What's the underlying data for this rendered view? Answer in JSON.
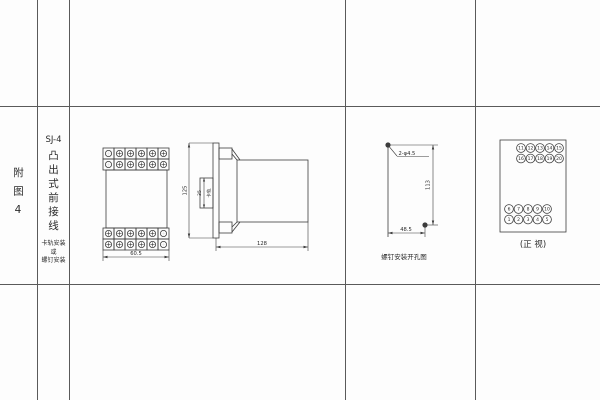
{
  "page": {
    "bg": "#fdfdfd",
    "line_color": "#3c3c3c",
    "text_color": "#2a2a2a"
  },
  "sidebar": {
    "figure_label": "附图4",
    "model": "SJ-4",
    "style_vertical": "凸出式前接线",
    "mount_note_line1": "卡轨安装",
    "mount_note_line2": "或",
    "mount_note_line3": "螺钉安装"
  },
  "front_view": {
    "width_dim": "60.5",
    "terminal_rows_per_block": 2,
    "terminal_cols": 6
  },
  "side_view": {
    "height_dim": "125",
    "rail_dim": "35",
    "rail_label": "卡轨",
    "depth_dim": "128"
  },
  "drill_view": {
    "hole_label": "2-φ4.5",
    "vertical_dim": "113",
    "horizontal_dim": "48.5",
    "caption": "螺钉安装开孔图"
  },
  "terminal_view": {
    "top_rows": [
      [
        "11",
        "12",
        "13",
        "14",
        "15"
      ],
      [
        "16",
        "17",
        "18",
        "19",
        "20"
      ]
    ],
    "bottom_rows": [
      [
        "6",
        "7",
        "8",
        "9",
        "10"
      ],
      [
        "1",
        "2",
        "3",
        "4",
        "5"
      ]
    ],
    "caption": "(正 视)"
  }
}
